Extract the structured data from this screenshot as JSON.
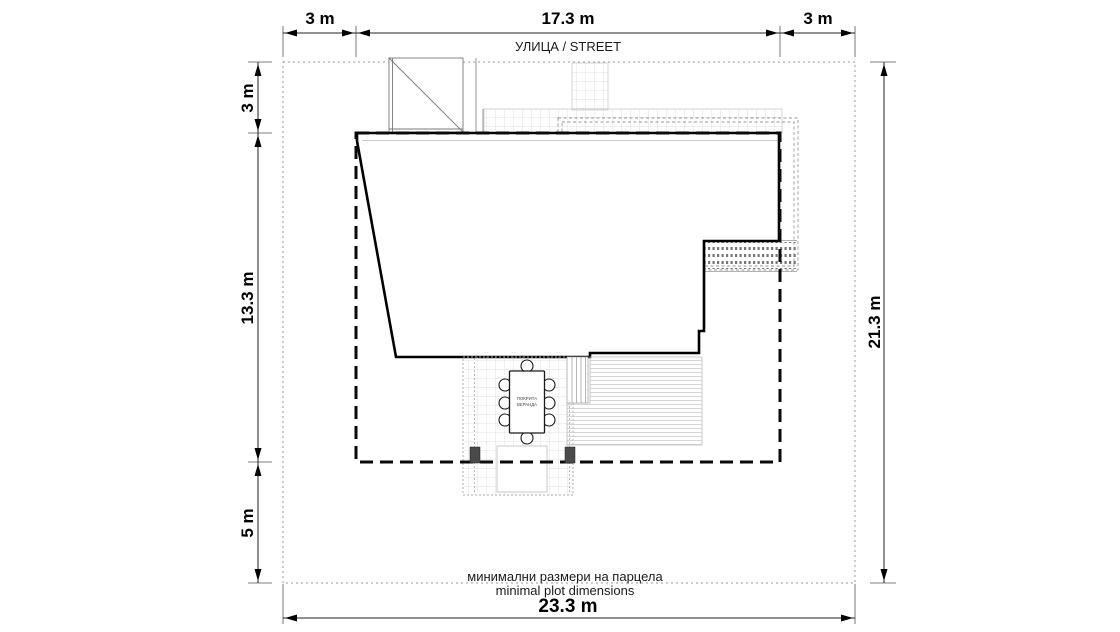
{
  "street_label": "УЛИЦА / STREET",
  "notes": {
    "line1": "минимални размери на парцела",
    "line2": "minimal plot dimensions"
  },
  "veranda": {
    "line1": "ПОКРИТА",
    "line2": "ВЕРАНДА"
  },
  "dimensions": {
    "top_left": "3 m",
    "top_center": "17.3 m",
    "top_right": "3 m",
    "left_top": "3 m",
    "left_middle": "13.3 m",
    "left_bottom": "5 m",
    "right_side": "21.3 m",
    "bottom": "23.3 m"
  },
  "colors": {
    "background": "#ffffff",
    "building_outline": "#000000",
    "setback_line": "#0a0a0a",
    "plot_boundary": "#9a9a9a",
    "paving_grid": "#d8d8d8",
    "roof_dash": "#999999",
    "column_fill": "#4a4a4a",
    "deck_line": "#cccccc"
  }
}
